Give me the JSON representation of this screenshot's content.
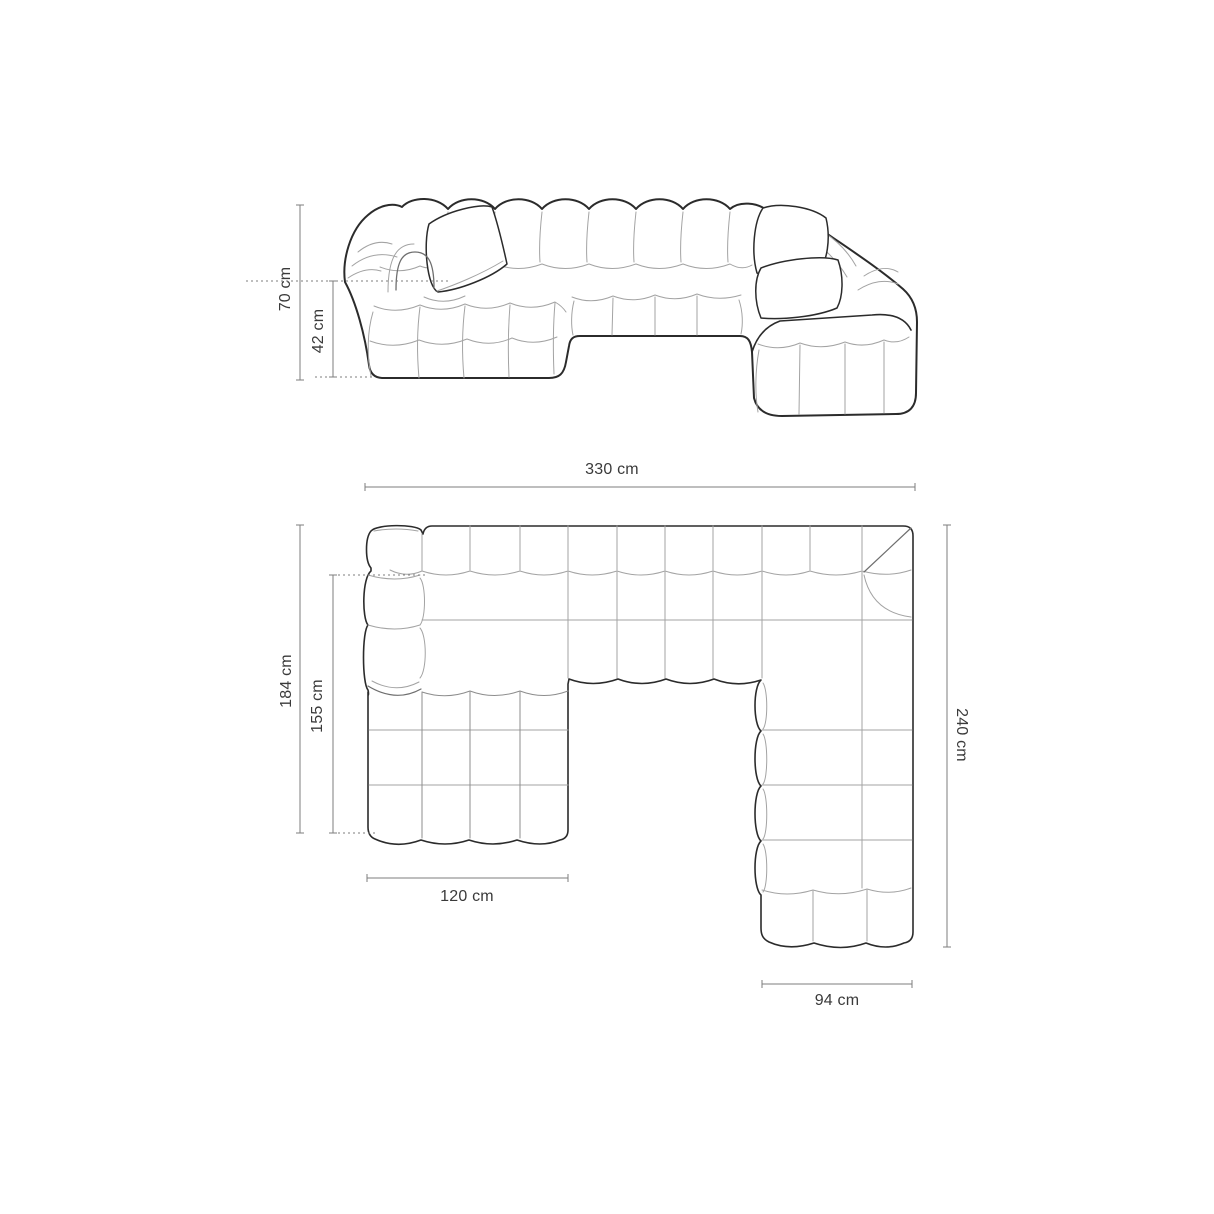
{
  "diagram": {
    "type": "furniture-dimension-drawing",
    "subject": "U-shaped modular channel-tufted sofa, front elevation and top plan views",
    "views": [
      {
        "id": "front-elevation",
        "dimensions": [
          {
            "name": "total_height",
            "label": "70 cm",
            "value": 70,
            "unit": "cm"
          },
          {
            "name": "seat_height",
            "label": "42 cm",
            "value": 42,
            "unit": "cm"
          }
        ]
      },
      {
        "id": "top-plan",
        "dimensions": [
          {
            "name": "total_width",
            "label": "330 cm",
            "value": 330,
            "unit": "cm"
          },
          {
            "name": "left_side_depth",
            "label": "184 cm",
            "value": 184,
            "unit": "cm"
          },
          {
            "name": "chaise_length",
            "label": "155 cm",
            "value": 155,
            "unit": "cm"
          },
          {
            "name": "right_side_depth",
            "label": "240 cm",
            "value": 240,
            "unit": "cm"
          },
          {
            "name": "left_chaise_width",
            "label": "120 cm",
            "value": 120,
            "unit": "cm"
          },
          {
            "name": "right_section_width",
            "label": "94 cm",
            "value": 94,
            "unit": "cm"
          }
        ]
      }
    ],
    "colors": {
      "background": "#ffffff",
      "outline": "#2b2b2b",
      "seam": "#a3a3a3",
      "dimension_line": "#7d7d7d",
      "label_text": "#3a3a3a"
    }
  },
  "labels": {
    "front_height": "70 cm",
    "front_seat_height": "42 cm",
    "plan_width": "330 cm",
    "plan_left_depth": "184 cm",
    "plan_chaise_length": "155 cm",
    "plan_right_depth": "240 cm",
    "plan_chaise_width": "120 cm",
    "plan_right_width": "94 cm"
  }
}
